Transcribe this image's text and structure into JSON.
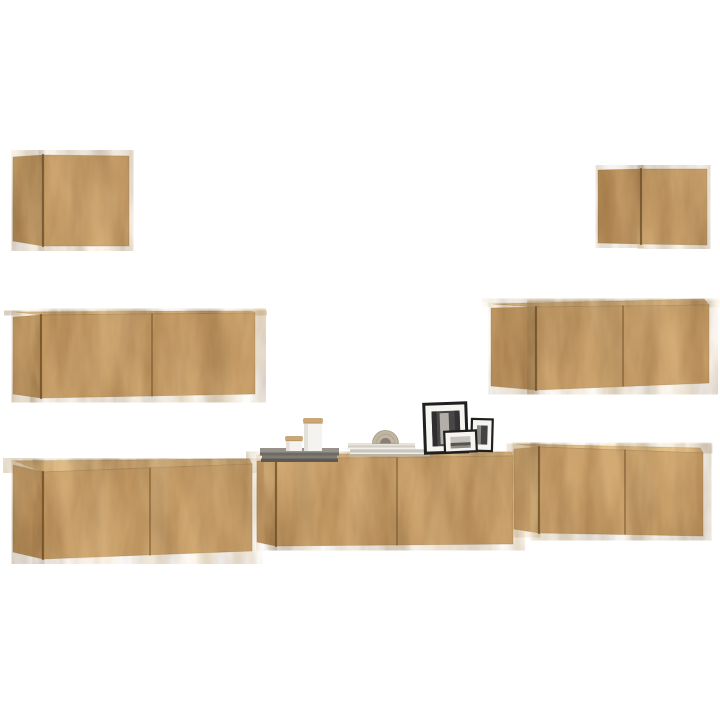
{
  "scene": {
    "background": "#ffffff",
    "palette": {
      "wood_front": "#c89d66",
      "wood_side": "#b78d58",
      "wood_top": "#dcb67f",
      "seam": "#6b4c26",
      "edge": "#8a6839",
      "grain_dark": "#6e4f2a",
      "grain_light": "#f0d3a0"
    },
    "cabinets": [
      {
        "name": "wall-cabinet-top-left",
        "side": [
          [
            13,
            157
          ],
          [
            43,
            155
          ],
          [
            43,
            246
          ],
          [
            13,
            241
          ]
        ],
        "front": [
          [
            43,
            155
          ],
          [
            129,
            156
          ],
          [
            129,
            246
          ],
          [
            43,
            246
          ]
        ],
        "seams": []
      },
      {
        "name": "wall-cabinet-top-right",
        "side": [
          [
            598,
            170
          ],
          [
            641,
            169
          ],
          [
            641,
            244
          ],
          [
            598,
            243
          ]
        ],
        "front": [
          [
            641,
            169
          ],
          [
            707,
            169
          ],
          [
            707,
            245
          ],
          [
            641,
            244
          ]
        ],
        "seams": []
      },
      {
        "name": "wall-cabinet-mid-left",
        "top": [
          [
            16,
            312
          ],
          [
            252,
            311
          ],
          [
            255,
            313
          ],
          [
            41,
            315
          ]
        ],
        "side": [
          [
            13,
            317
          ],
          [
            41,
            315
          ],
          [
            41,
            398
          ],
          [
            13,
            394
          ]
        ],
        "front": [
          [
            41,
            315
          ],
          [
            255,
            313
          ],
          [
            255,
            394
          ],
          [
            41,
            398
          ]
        ],
        "seams": [
          [
            [
              152,
              314
            ],
            [
              152,
              396
            ]
          ]
        ]
      },
      {
        "name": "wall-cabinet-mid-right",
        "top": [
          [
            493,
            304
          ],
          [
            704,
            299
          ],
          [
            709,
            305
          ],
          [
            536,
            307
          ]
        ],
        "side": [
          [
            491,
            308
          ],
          [
            536,
            307
          ],
          [
            536,
            390
          ],
          [
            491,
            386
          ]
        ],
        "front": [
          [
            536,
            307
          ],
          [
            709,
            305
          ],
          [
            709,
            383
          ],
          [
            536,
            390
          ]
        ],
        "seams": [
          [
            [
              623,
              306
            ],
            [
              623,
              386
            ]
          ]
        ]
      },
      {
        "name": "tv-cabinet-bottom-left",
        "top": [
          [
            15,
            461
          ],
          [
            249,
            459
          ],
          [
            252,
            464
          ],
          [
            43,
            472
          ]
        ],
        "side": [
          [
            13,
            465
          ],
          [
            43,
            472
          ],
          [
            43,
            559
          ],
          [
            13,
            552
          ]
        ],
        "front": [
          [
            43,
            472
          ],
          [
            252,
            464
          ],
          [
            252,
            551
          ],
          [
            43,
            559
          ]
        ],
        "seams": [
          [
            [
              150,
              468
            ],
            [
              150,
              555
            ]
          ]
        ]
      },
      {
        "name": "tv-cabinet-bottom-middle",
        "top": [
          [
            259,
            455
          ],
          [
            511,
            452
          ],
          [
            513,
            456
          ],
          [
            276,
            459
          ]
        ],
        "side": [
          [
            257,
            461
          ],
          [
            276,
            459
          ],
          [
            276,
            546
          ],
          [
            257,
            542
          ]
        ],
        "front": [
          [
            276,
            459
          ],
          [
            513,
            456
          ],
          [
            513,
            544
          ],
          [
            276,
            546
          ]
        ],
        "seams": [
          [
            [
              397,
              458
            ],
            [
              397,
              545
            ]
          ]
        ]
      },
      {
        "name": "tv-cabinet-bottom-right",
        "top": [
          [
            516,
            444
          ],
          [
            700,
            448
          ],
          [
            703,
            453
          ],
          [
            539,
            447
          ]
        ],
        "side": [
          [
            514,
            449
          ],
          [
            539,
            447
          ],
          [
            539,
            533
          ],
          [
            514,
            529
          ]
        ],
        "front": [
          [
            539,
            447
          ],
          [
            703,
            453
          ],
          [
            703,
            536
          ],
          [
            539,
            533
          ]
        ],
        "seams": [
          [
            [
              625,
              450
            ],
            [
              625,
              534
            ]
          ]
        ]
      }
    ],
    "decor": {
      "stacks": [
        {
          "name": "book-stack-gray",
          "slabs": [
            {
              "x": 260,
              "y": 448,
              "w": 79,
              "h": 4.5,
              "fill": "#96918a"
            },
            {
              "x": 260,
              "y": 452.5,
              "w": 79,
              "h": 3,
              "fill": "#6e6a64"
            },
            {
              "x": 262,
              "y": 455.5,
              "w": 75,
              "h": 3,
              "fill": "#807b74"
            },
            {
              "x": 261,
              "y": 458.5,
              "w": 77,
              "h": 3.5,
              "fill": "#5c5853"
            }
          ]
        },
        {
          "name": "book-stack-light",
          "slabs": [
            {
              "x": 348,
              "y": 443,
              "w": 67,
              "h": 2.5,
              "fill": "#e8e4db"
            },
            {
              "x": 348,
              "y": 445.5,
              "w": 67,
              "h": 2.2,
              "fill": "#d2cdc3"
            },
            {
              "x": 347,
              "y": 447.7,
              "w": 69,
              "h": 1.6,
              "fill": "#f2f0ea"
            },
            {
              "x": 350,
              "y": 449.3,
              "w": 80,
              "h": 3.2,
              "fill": "#ccc7bd"
            },
            {
              "x": 350,
              "y": 452.5,
              "w": 80,
              "h": 1.6,
              "fill": "#efede7"
            },
            {
              "x": 349,
              "y": 454.1,
              "w": 81,
              "h": 2.4,
              "fill": "#b9b4aa"
            }
          ]
        }
      ],
      "jars": [
        {
          "name": "storage-jar-small",
          "parts": [
            {
              "x": 285,
              "y": 436,
              "w": 18,
              "h": 4.5,
              "fill": "#c9a77a",
              "rx": 2
            },
            {
              "x": 285.5,
              "y": 440.2,
              "w": 17,
              "h": 1.2,
              "fill": "#b5945f"
            },
            {
              "x": 286,
              "y": 441.2,
              "w": 16,
              "h": 9.8,
              "fill": "#f4f2ee"
            },
            {
              "x": 286,
              "y": 441.2,
              "w": 3.5,
              "h": 9.8,
              "fill": "#e2dfd8"
            }
          ]
        },
        {
          "name": "storage-jar-large",
          "parts": [
            {
              "x": 303,
              "y": 418,
              "w": 20,
              "h": 5,
              "fill": "#c9a77a",
              "rx": 2
            },
            {
              "x": 303.5,
              "y": 422.6,
              "w": 19,
              "h": 1.2,
              "fill": "#b5945f"
            },
            {
              "x": 304,
              "y": 423.6,
              "w": 18,
              "h": 27.4,
              "fill": "#f5f3ef"
            },
            {
              "x": 304,
              "y": 423.6,
              "w": 4,
              "h": 27.4,
              "fill": "#e4e1da"
            }
          ]
        }
      ],
      "arch": {
        "name": "arch-ornament",
        "cx": 385.5,
        "base": 443.5,
        "r_outer": 13,
        "r_hole": 5.5,
        "body": "#c1b6a3",
        "hole": "#897f72",
        "rib": "#a99c86"
      },
      "frames": [
        {
          "name": "picture-frame-large",
          "x": 424,
          "y": 402,
          "w": 45,
          "h": 52,
          "tilt": -2,
          "border": 3,
          "frame": "#1f1f1f",
          "mat": "#f6f5f2",
          "photo": {
            "x": 433,
            "y": 411,
            "w": 28,
            "h": 35,
            "fill": "#474747"
          },
          "details": [
            {
              "x": 441,
              "y": 413,
              "w": 9,
              "h": 31,
              "fill": "#b3afa8"
            },
            {
              "x": 433,
              "y": 411,
              "w": 5,
              "h": 35,
              "fill": "#2e2e2e"
            },
            {
              "x": 456,
              "y": 411,
              "w": 5,
              "h": 35,
              "fill": "#333333"
            }
          ]
        },
        {
          "name": "picture-frame-medium",
          "x": 470,
          "y": 418,
          "w": 23,
          "h": 34,
          "tilt": 1.5,
          "border": 2.2,
          "frame": "#1f1f1f",
          "mat": "#f6f5f2",
          "photo": {
            "x": 476.5,
            "y": 425.5,
            "w": 10.5,
            "h": 19,
            "fill": "#434343"
          },
          "details": [
            {
              "x": 476.5,
              "y": 425.5,
              "w": 4,
              "h": 19,
              "fill": "#8e8a84"
            }
          ]
        },
        {
          "name": "picture-frame-small",
          "x": 444,
          "y": 430,
          "w": 34,
          "h": 23,
          "tilt": -2.5,
          "border": 2.2,
          "frame": "#1f1f1f",
          "mat": "#f6f5f2",
          "photo": {
            "x": 451,
            "y": 436.5,
            "w": 20,
            "h": 11.5,
            "fill": "#c6c3be"
          },
          "details": [
            {
              "x": 451,
              "y": 442.5,
              "w": 20,
              "h": 3.2,
              "fill": "#57544f"
            },
            {
              "x": 451,
              "y": 445.7,
              "w": 20,
              "h": 2.3,
              "fill": "#8f8c86"
            }
          ]
        }
      ]
    }
  }
}
